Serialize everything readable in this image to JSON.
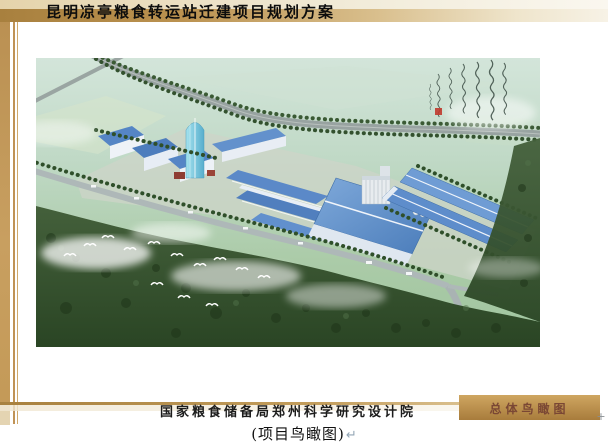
{
  "header": {
    "title": "昆明凉亭粮食转运站迁建项目规划方案"
  },
  "artwork": {
    "alt": "项目鸟瞰图",
    "seal_color": "#c03a2c"
  },
  "footer": {
    "institute": "国家粮食储备局郑州科学研究设计院",
    "tab_label": "总体鸟瞰图",
    "anchor_mark": "+"
  },
  "caption": {
    "text": "(项目鸟瞰图)",
    "mark": "↵"
  },
  "colors": {
    "accent_gold": "#b98f4a",
    "roof_blue": "#4e82c2",
    "forest_green": "#2a4524",
    "tab_text": "#7a4734"
  }
}
